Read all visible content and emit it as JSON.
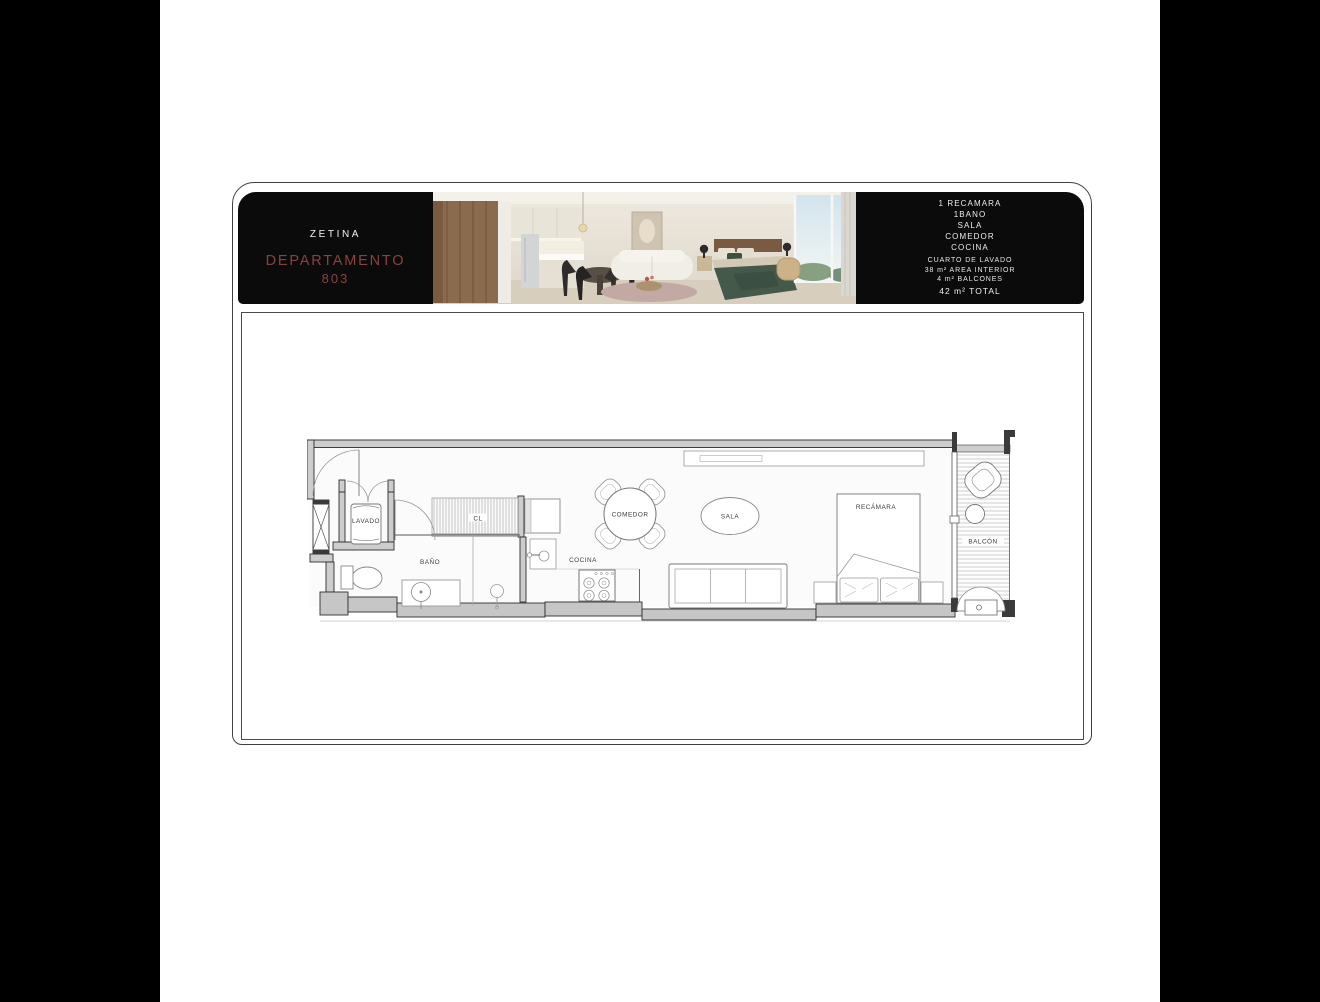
{
  "banner": {
    "left": {
      "building": "ZETINA",
      "unit_label": "DEPARTAMENTO",
      "unit_number": "803",
      "accent_color": "#8a423e"
    },
    "right": {
      "features": [
        "1 RECAMARA",
        "1BANO",
        "SALA",
        "COMEDOR",
        "COCINA"
      ],
      "details": [
        "CUARTO DE LAVADO",
        "38 m² AREA INTERIOR",
        "4 m² BALCONES"
      ],
      "total": "42 m² TOTAL"
    }
  },
  "floorplan": {
    "rooms": [
      {
        "id": "lavado",
        "label": "LAVADO"
      },
      {
        "id": "bano",
        "label": "BAÑO"
      },
      {
        "id": "cl",
        "label": "CL"
      },
      {
        "id": "cocina",
        "label": "COCINA"
      },
      {
        "id": "comedor",
        "label": "COMEDOR"
      },
      {
        "id": "sala",
        "label": "SALA"
      },
      {
        "id": "recamara",
        "label": "RECÁMARA"
      },
      {
        "id": "balcon",
        "label": "BALCÓN"
      }
    ]
  }
}
